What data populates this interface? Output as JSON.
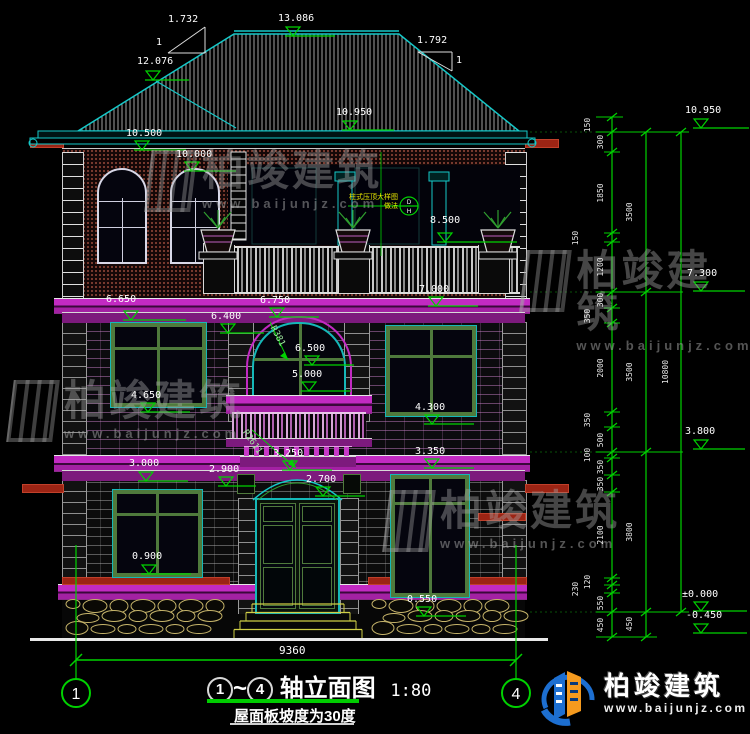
{
  "drawing": {
    "axis_left": "1",
    "axis_right": "4",
    "title_circle_left": "1",
    "title_tilde": "~",
    "title_circle_right": "4",
    "title_main": "轴立面图",
    "scale": "1:80",
    "subtitle": "屋面板坡度为30度",
    "overall_width": "9360"
  },
  "slope_left": {
    "run": "1.732",
    "rise": "1"
  },
  "slope_right": {
    "run": "1.792",
    "rise": "1"
  },
  "facade_levels": [
    "13.086",
    "12.076",
    "10.950",
    "10.500",
    "10.000",
    "8.500",
    "6.650",
    "6.750",
    "7.000",
    "6.400",
    "6.500",
    "5.000",
    "4.650",
    "4.300",
    "3.000",
    "3.350",
    "2.900",
    "3.250",
    "2.700",
    "0.900",
    "0.550"
  ],
  "right_datum_levels": [
    "10.950",
    "7.300",
    "3.800",
    "±0.000",
    "-0.450"
  ],
  "dim_col1": [
    "150",
    "300",
    "1850",
    "150",
    "1200",
    "300",
    "350",
    "2000",
    "350",
    "500",
    "100",
    "350",
    "350",
    "2100",
    "120",
    "230",
    "550",
    "450"
  ],
  "dim_col2": [
    "3500",
    "3500",
    "3800",
    "450"
  ],
  "dim_col3": [
    "10800"
  ],
  "radius_labels": [
    "R381",
    "R2611"
  ],
  "detail_note": {
    "line1": "柱式压顶大样图",
    "line2": "做法",
    "ref_top": "D",
    "ref_bottom": "H"
  },
  "watermark": {
    "brand": "柏竣建筑",
    "url": "www.baijunjz.com"
  },
  "logo": {
    "brand": "柏竣建筑",
    "url": "www.baijunjz.com"
  },
  "colors": {
    "line_cyan": "#15c8c8",
    "line_green": "#00d200",
    "line_magenta": "#c22ac2",
    "line_white": "#e8e8e8",
    "hatch": "#c8c8c8",
    "stone": "#c6b46a",
    "steps_yellow": "#cfcf46",
    "note_yellow": "#e8e800",
    "red_accent": "#9c2414",
    "logo_blue": "#1d6fd1",
    "logo_orange": "#f59a1e"
  }
}
